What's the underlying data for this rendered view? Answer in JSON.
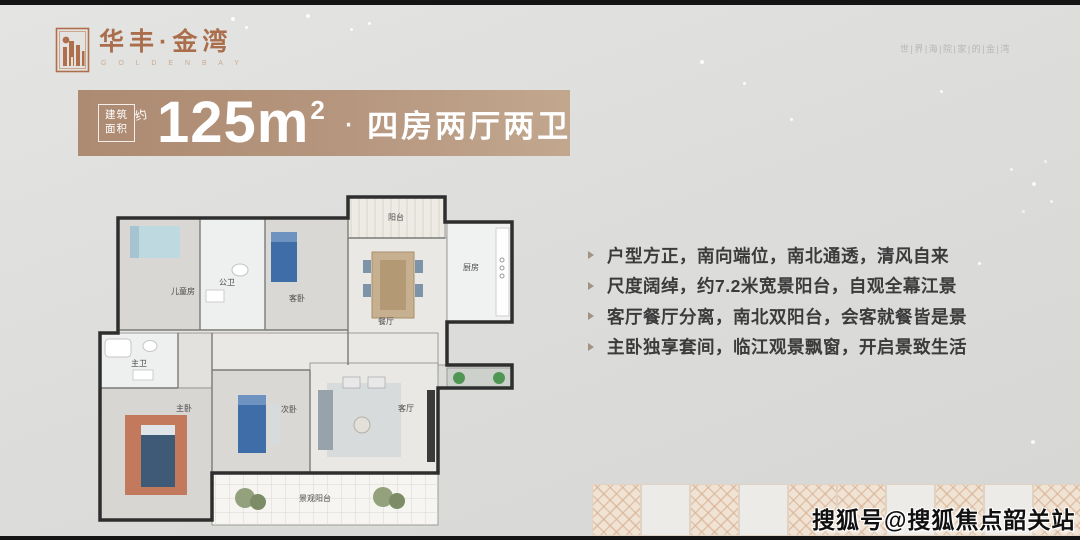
{
  "brand": {
    "name": "华丰·金湾",
    "sub": "G O L D E N  B A Y",
    "tagline": "世|界|海|院|家|的|金|湾",
    "color": "#aa6e4d"
  },
  "banner": {
    "area_box_line1": "建筑",
    "area_box_line2": "面积",
    "approx": "约",
    "value": "125m",
    "sup": "2",
    "dot": "·",
    "layout": "四房两厅两卫",
    "bg_from": "#ad8a72",
    "bg_to": "#c2a78f"
  },
  "features": [
    "户型方正，南向端位，南北通透，清风自来",
    "尺度阔绰，约7.2米宽景阳台，自观全幕江景",
    "客厅餐厅分离，南北双阳台，会客就餐皆是景",
    "主卧独享套间，临江观景飘窗，开启景致生活"
  ],
  "floorplan": {
    "labels": [
      {
        "t": "阳台",
        "x": 321,
        "y": 30
      },
      {
        "t": "厨房",
        "x": 396,
        "y": 80
      },
      {
        "t": "儿童房",
        "x": 108,
        "y": 104
      },
      {
        "t": "公卫",
        "x": 152,
        "y": 95
      },
      {
        "t": "客卧",
        "x": 222,
        "y": 111
      },
      {
        "t": "餐厅",
        "x": 311,
        "y": 134
      },
      {
        "t": "主卫",
        "x": 64,
        "y": 176
      },
      {
        "t": "主卧",
        "x": 109,
        "y": 221
      },
      {
        "t": "次卧",
        "x": 214,
        "y": 222
      },
      {
        "t": "客厅",
        "x": 331,
        "y": 221
      },
      {
        "t": "景观阳台",
        "x": 240,
        "y": 311
      }
    ]
  },
  "watermark": "搜狐号@搜狐焦点韶关站",
  "colors": {
    "background": "#dddddb",
    "feature_text": "#3b3b3b",
    "tile_pattern": "#f0e3d4",
    "wall": "#2e2e2e"
  }
}
